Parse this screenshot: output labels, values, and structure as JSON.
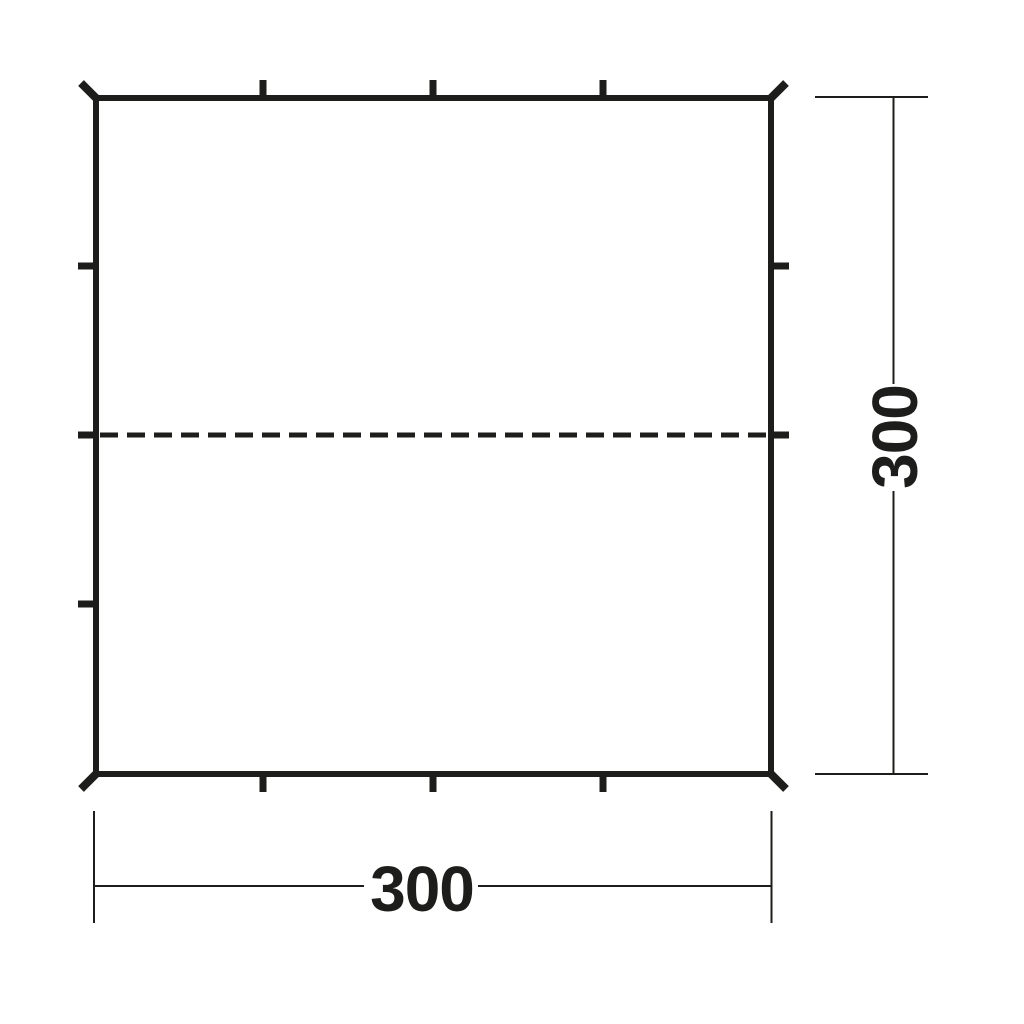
{
  "drawing": {
    "type": "technical-dimension-diagram",
    "subject": "square tarp plan view",
    "line_color": "#1d1d1b",
    "background_color": "#ffffff",
    "width_dimension": {
      "value": "300"
    },
    "height_dimension": {
      "value": "300"
    }
  }
}
